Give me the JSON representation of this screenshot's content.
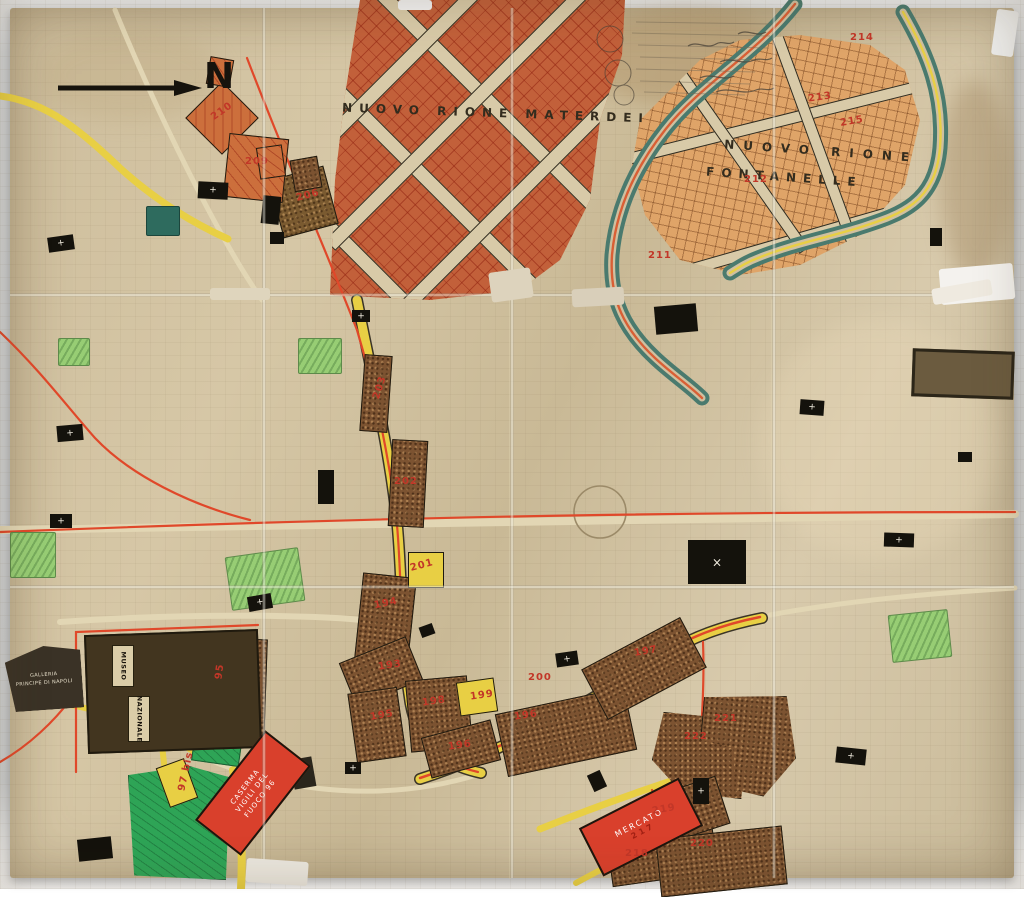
{
  "map": {
    "north_label": "N",
    "districts": {
      "materdei_label": "NUOVO RIONE MATERDEI",
      "fontanelle_label_line1": "NUOVO RIONE",
      "fontanelle_label_line2": "FONTANELLE"
    },
    "buildings": {
      "museo_line1": "MUSEO",
      "museo_line2": "NAZIONALE",
      "galleria_line1": "GALLERIA",
      "galleria_line2": "PRINCIPE DI NAPOLI",
      "caserma_line1": "CASERMA",
      "caserma_line2": "VIGILI DEL",
      "caserma_line3": "FUOCO 96",
      "mercato_line1": "MERCATO",
      "mercato_line2": "217"
    },
    "church_cross_symbol": "+",
    "big_church_cross_symbol": "×",
    "parcel_numbers": [
      {
        "label": "210",
        "x": 210,
        "y": 106,
        "rot": -35
      },
      {
        "label": "209",
        "x": 245,
        "y": 156,
        "rot": 0
      },
      {
        "label": "206",
        "x": 296,
        "y": 190,
        "rot": -15
      },
      {
        "label": "211",
        "x": 648,
        "y": 250,
        "rot": 0
      },
      {
        "label": "212",
        "x": 744,
        "y": 174,
        "rot": 0
      },
      {
        "label": "213",
        "x": 808,
        "y": 92,
        "rot": -8
      },
      {
        "label": "214",
        "x": 850,
        "y": 32,
        "rot": 0
      },
      {
        "label": "215",
        "x": 840,
        "y": 116,
        "rot": -10
      },
      {
        "label": "203",
        "x": 368,
        "y": 382,
        "rot": -72
      },
      {
        "label": "202",
        "x": 394,
        "y": 476,
        "rot": 0
      },
      {
        "label": "201",
        "x": 410,
        "y": 560,
        "rot": -15
      },
      {
        "label": "194",
        "x": 374,
        "y": 598,
        "rot": -12
      },
      {
        "label": "193",
        "x": 378,
        "y": 660,
        "rot": -8
      },
      {
        "label": "195",
        "x": 370,
        "y": 710,
        "rot": -10
      },
      {
        "label": "198",
        "x": 422,
        "y": 696,
        "rot": -8
      },
      {
        "label": "199",
        "x": 470,
        "y": 690,
        "rot": -8
      },
      {
        "label": "196",
        "x": 448,
        "y": 740,
        "rot": -8
      },
      {
        "label": "196",
        "x": 514,
        "y": 710,
        "rot": -8
      },
      {
        "label": "200",
        "x": 528,
        "y": 672,
        "rot": 0
      },
      {
        "label": "197",
        "x": 634,
        "y": 646,
        "rot": -10
      },
      {
        "label": "222",
        "x": 684,
        "y": 731,
        "rot": 0
      },
      {
        "label": "221",
        "x": 714,
        "y": 713,
        "rot": 0
      },
      {
        "label": "219",
        "x": 652,
        "y": 804,
        "rot": -10
      },
      {
        "label": "218",
        "x": 625,
        "y": 848,
        "rot": 0
      },
      {
        "label": "220",
        "x": 690,
        "y": 838,
        "rot": 0
      },
      {
        "label": "95",
        "x": 212,
        "y": 666,
        "rot": -82
      },
      {
        "label": "97 bis",
        "x": 166,
        "y": 766,
        "rot": -78
      }
    ],
    "colors": {
      "paper": "#cfc0a0",
      "road_red": "#e0482a",
      "road_yellow": "#e8cf44",
      "waterway_teal": "#4a7a6e",
      "parcel_brown": "#7c5331",
      "district_orange": "#c2603a",
      "district_light_orange": "#dfa468",
      "park_green": "#2ea456",
      "park_light_green": "#97cd74",
      "number_red": "#c23728",
      "highlight_red_block": "#d9402c"
    }
  }
}
